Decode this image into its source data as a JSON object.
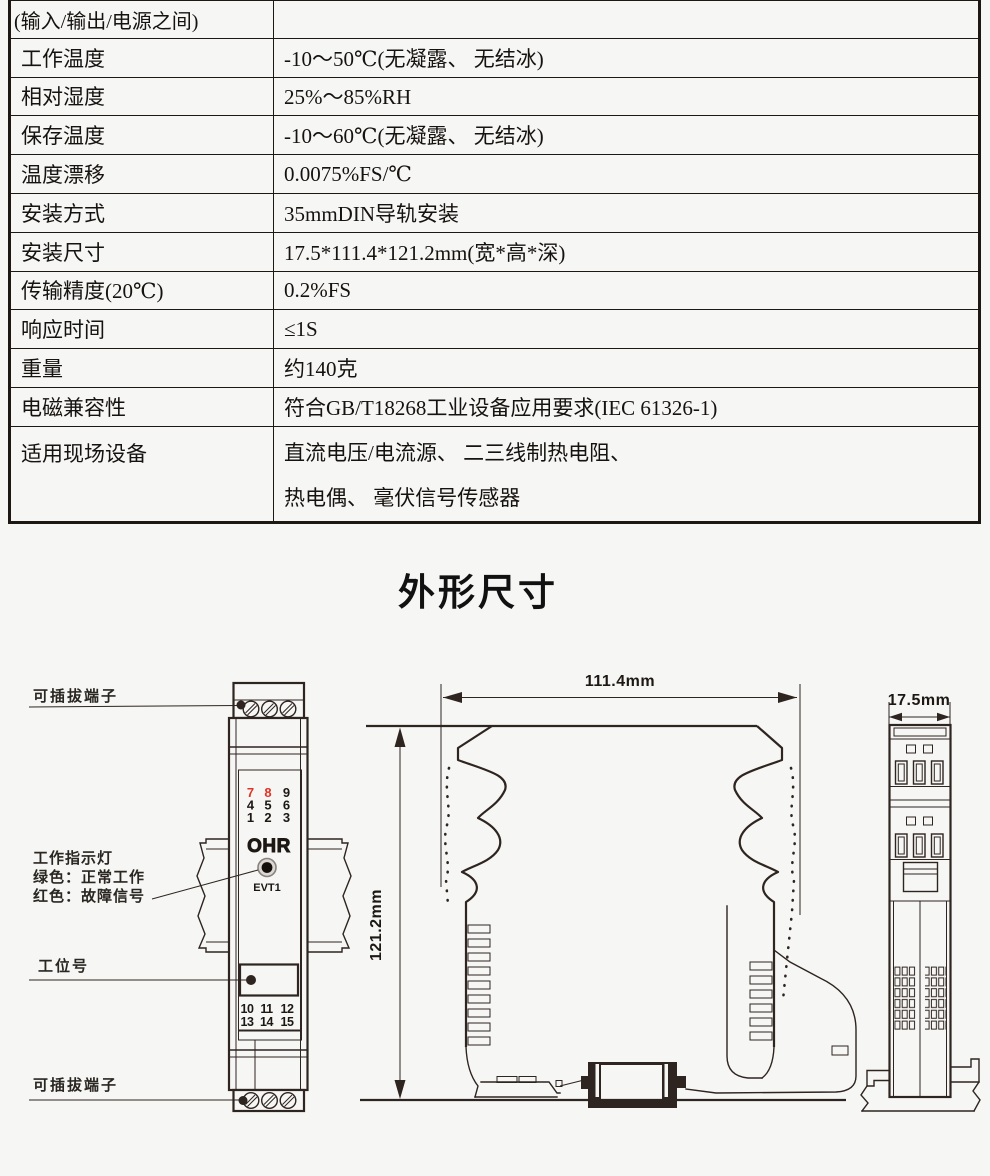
{
  "colors": {
    "background": "#f6f6f4",
    "line": "#2e2420",
    "table_border": "#1d1814",
    "red_accent": "#df3527"
  },
  "spec_table": {
    "rows": [
      {
        "label": "(输入/输出/电源之间)",
        "value": ""
      },
      {
        "label": "工作温度",
        "value": "-10～50℃(无凝露、 无结冰)"
      },
      {
        "label": "相对湿度",
        "value": "25%～85%RH"
      },
      {
        "label": "保存温度",
        "value": "-10～60℃(无凝露、 无结冰)"
      },
      {
        "label": "温度漂移",
        "value": "0.0075%FS/℃"
      },
      {
        "label": "安装方式",
        "value": "35mmDIN导轨安装"
      },
      {
        "label": "安装尺寸",
        "value": "17.5*111.4*121.2mm(宽*高*深)"
      },
      {
        "label": "传输精度(20℃)",
        "value": "0.2%FS"
      },
      {
        "label": "响应时间",
        "value": "≤1S"
      },
      {
        "label": "重量",
        "value": "约140克"
      },
      {
        "label": "电磁兼容性",
        "value": "符合GB/T18268工业设备应用要求(IEC 61326-1)"
      },
      {
        "label": "适用现场设备",
        "value": "直流电压/电流源、 二三线制热电阻、",
        "value2": "热电偶、 毫伏信号传感器"
      }
    ]
  },
  "section_title": "外形尺寸",
  "drawing": {
    "callouts": {
      "terminal_top": "可插拔端子",
      "indicator_title": "工作指示灯",
      "indicator_green": "绿色：正常工作",
      "indicator_red": "红色：故障信号",
      "station_no": "工位号",
      "terminal_bottom": "可插拔端子"
    },
    "front_view": {
      "brand": "OHR",
      "led_label": "EVT1",
      "top_terminal_rows": [
        [
          "7",
          "8",
          "9"
        ],
        [
          "4",
          "5",
          "6"
        ],
        [
          "1",
          "2",
          "3"
        ]
      ],
      "bottom_terminal_rows": [
        [
          "10",
          "11",
          "12"
        ],
        [
          "13",
          "14",
          "15"
        ]
      ],
      "red_terminals": [
        "7",
        "8"
      ]
    },
    "dimensions": {
      "dim_width": "111.4mm",
      "dim_depth": "121.2mm",
      "dim_side": "17.5mm"
    }
  }
}
